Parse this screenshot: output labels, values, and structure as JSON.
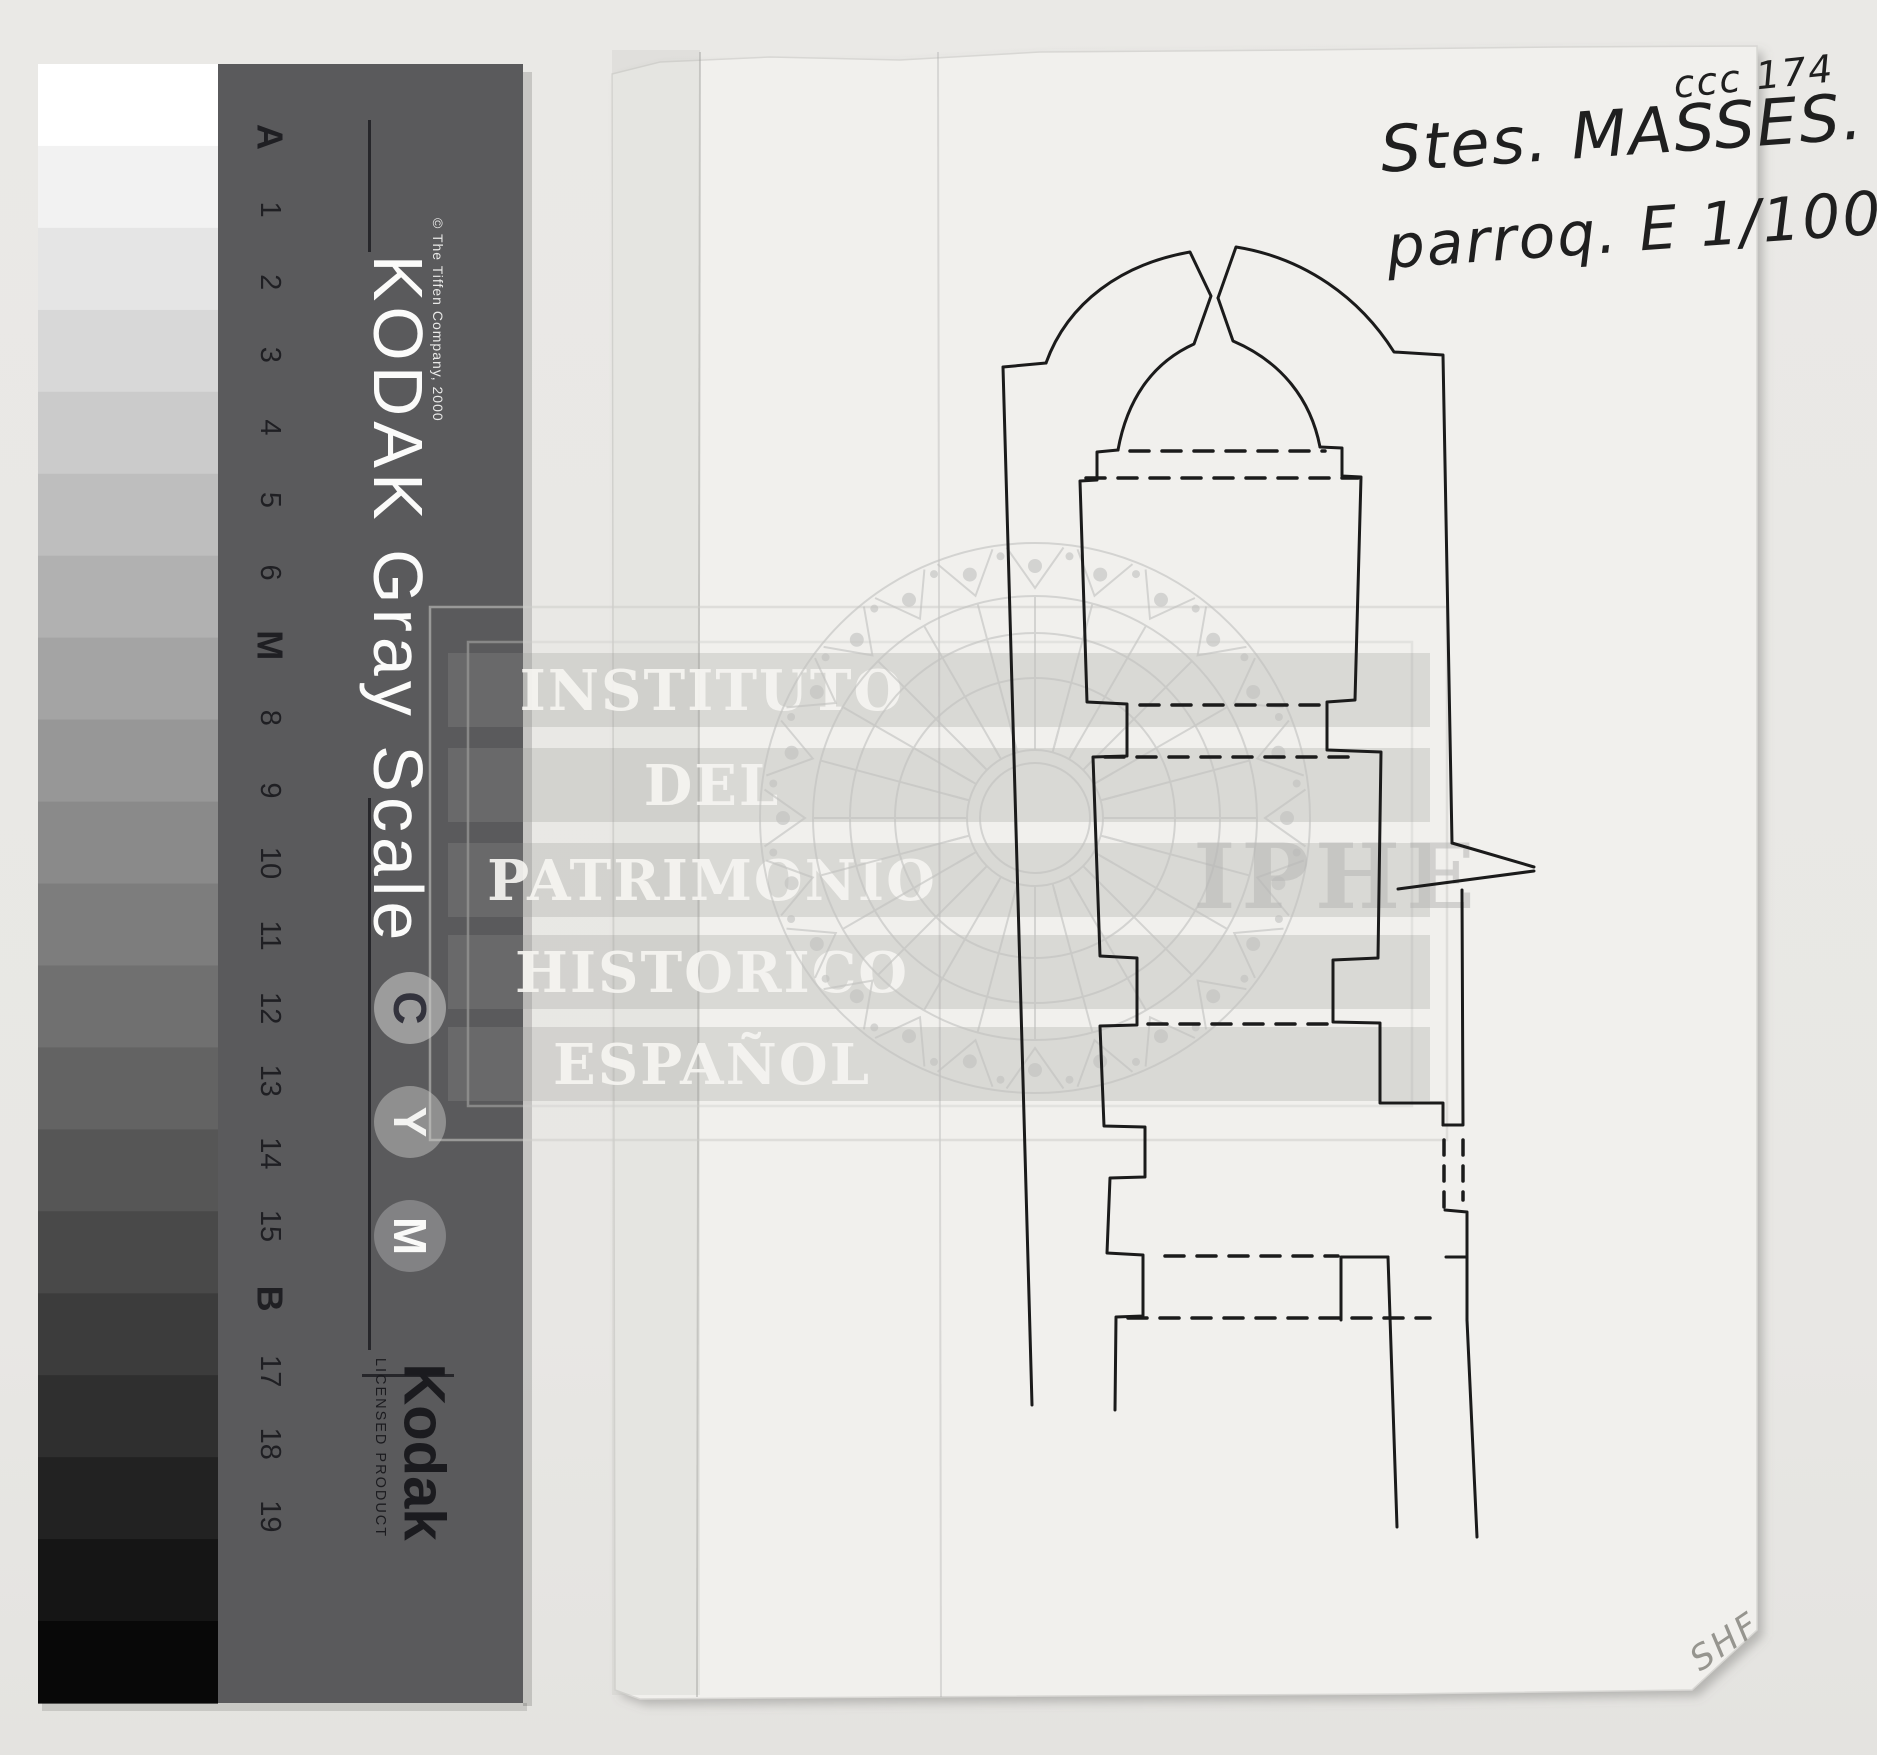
{
  "photo": {
    "background_color": "#e8e7e4",
    "paper_color": "#f1f0ed",
    "shadow_color": "rgba(0,0,0,0.14)"
  },
  "gray_scale_card": {
    "title": "KODAK Gray Scale",
    "copyright": "© The Tiffen Company, 2000",
    "step_labels": [
      "A",
      "1",
      "2",
      "3",
      "4",
      "5",
      "6",
      "M",
      "8",
      "9",
      "10",
      "11",
      "12",
      "13",
      "14",
      "15",
      "B",
      "17",
      "18",
      "19"
    ],
    "bold_labels": [
      "A",
      "M",
      "B"
    ],
    "patch_grays": [
      255,
      242,
      229,
      216,
      203,
      190,
      177,
      164,
      151,
      138,
      125,
      112,
      99,
      86,
      73,
      60,
      47,
      34,
      21,
      8
    ],
    "cym_badges": [
      "C",
      "Y",
      "M"
    ],
    "footer_brand": "Kodak",
    "footer_license": "LICENSED PRODUCT",
    "panel_color": "#5a5a5c",
    "label_color": "#1f1f23",
    "title_color": "#fbfbfa"
  },
  "watermark": {
    "lines": [
      "INSTITUTO",
      "DEL",
      "PATRIMONIO",
      "HISTORICO",
      "ESPAÑOL"
    ],
    "acronym": "IPHE",
    "line_color": "#c2c2c0",
    "band_fill": "rgba(150,150,148,0.26)",
    "text_fill": "rgba(245,244,241,0.92)"
  },
  "annotations": {
    "reference_code": "ccc 174",
    "title": "Stes. MASSES.",
    "scale_note": "parroq. E 1/100",
    "corner_initials": "SHF",
    "ink_color": "#1f1f1f",
    "pencil_color": "#96958f"
  },
  "plan": {
    "subject": "single-nave church floor plan with apse, traced in black ink",
    "ink_color": "#1b1b1b"
  }
}
